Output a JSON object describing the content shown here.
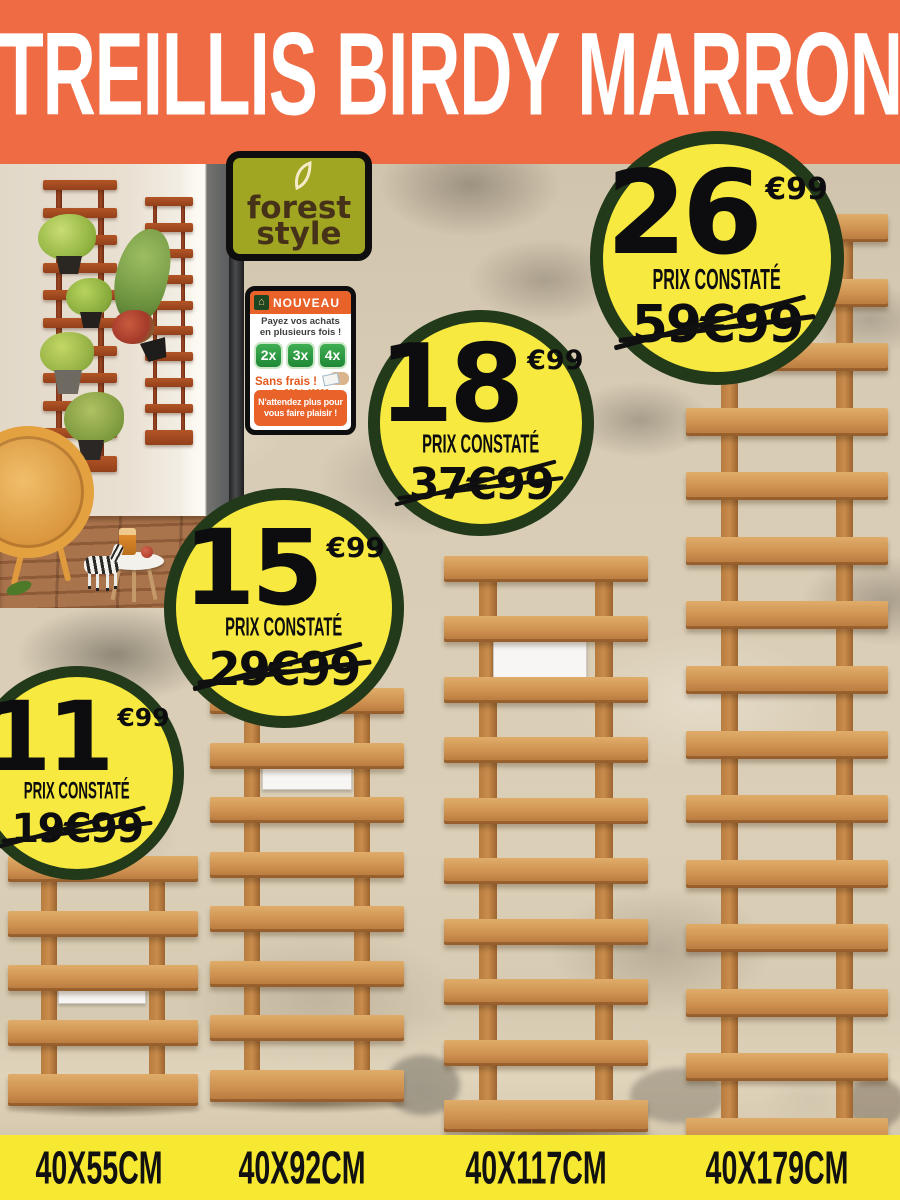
{
  "banner": {
    "title": "TREILLIS BIRDY MARRON"
  },
  "brand": {
    "logo_line1": "forest",
    "logo_line2": "style"
  },
  "promo_sign": {
    "header_label": "NOUVEAU",
    "line1": "Payez vos achats",
    "line2": "en plusieurs fois !",
    "installments": [
      "2x",
      "3x",
      "4x"
    ],
    "no_fees": "Sans frais !",
    "range": "De 90€ à 4000€",
    "fine_print": "Financement",
    "footer_line1": "N'attendez plus pour",
    "footer_line2": "vous faire plaisir !"
  },
  "badges": {
    "label": "PRIX CONSTATÉ",
    "items": [
      {
        "price_whole": "11",
        "price_cents": "€99",
        "old_price": "19€99"
      },
      {
        "price_whole": "15",
        "price_cents": "€99",
        "old_price": "29€99"
      },
      {
        "price_whole": "18",
        "price_cents": "€99",
        "old_price": "37€99"
      },
      {
        "price_whole": "26",
        "price_cents": "€99",
        "old_price": "59€99"
      }
    ]
  },
  "sizes": {
    "items": [
      "40X55CM",
      "40X92CM",
      "40X117CM",
      "40X179CM"
    ]
  },
  "colors": {
    "banner_orange": "#EF6B44",
    "badge_yellow": "#F7E93F",
    "badge_ring_green": "#22391A",
    "size_bar_yellow": "#F7E832",
    "promo_orange": "#E8622A",
    "installment_green": "#2E9B43",
    "logo_olive": "#A0A621",
    "wood_brown": "#CE9150"
  }
}
